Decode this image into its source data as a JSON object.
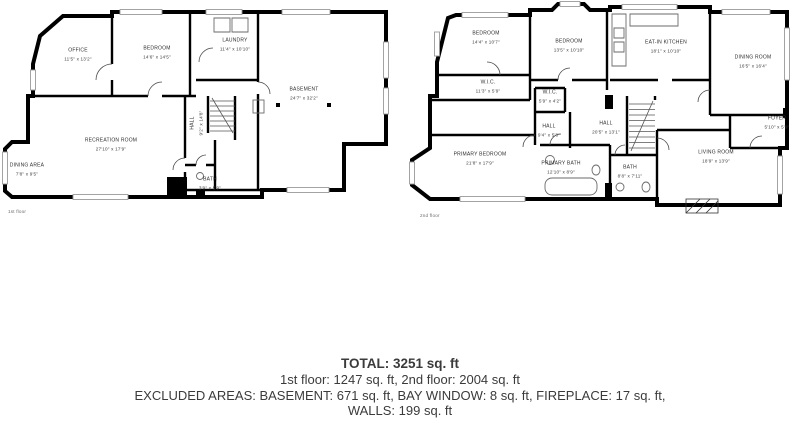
{
  "floor1": {
    "label": "1st floor",
    "rooms": [
      {
        "name": "OFFICE",
        "dims": "11'5\" x 13'2\""
      },
      {
        "name": "BEDROOM",
        "dims": "14'6\" x 14'5\""
      },
      {
        "name": "LAUNDRY",
        "dims": "11'4\" x 10'10\""
      },
      {
        "name": "BASEMENT",
        "dims": "24'7\" x 32'2\""
      },
      {
        "name": "RECREATION ROOM",
        "dims": "27'10\" x 17'9\""
      },
      {
        "name": "DINING AREA",
        "dims": "7'8\" x 9'5\""
      },
      {
        "name": "HALL",
        "dims": "9'2\" x 14'8\""
      },
      {
        "name": "BATH",
        "dims": "3'9\" x 5'9\""
      }
    ]
  },
  "floor2": {
    "label": "2nd floor",
    "rooms": [
      {
        "name": "BEDROOM",
        "dims": "14'4\" x 10'7\""
      },
      {
        "name": "BEDROOM",
        "dims": "13'5\" x 10'10\""
      },
      {
        "name": "EAT-IN KITCHEN",
        "dims": "18'1\" x 10'10\""
      },
      {
        "name": "DINING ROOM",
        "dims": "16'5\" x 16'4\""
      },
      {
        "name": "W.I.C.",
        "dims": "11'3\" x 5'9\""
      },
      {
        "name": "W.I.C.",
        "dims": "5'9\" x 4'2\""
      },
      {
        "name": "HALL",
        "dims": "9'4\" x 5'8\""
      },
      {
        "name": "HALL",
        "dims": "20'5\" x 13'1\""
      },
      {
        "name": "PRIMARY BEDROOM",
        "dims": "21'8\" x 17'9\""
      },
      {
        "name": "PRIMARY BATH",
        "dims": "12'10\" x 8'9\""
      },
      {
        "name": "BATH",
        "dims": "8'8\" x 7'11\""
      },
      {
        "name": "LIVING ROOM",
        "dims": "18'9\" x 13'9\""
      },
      {
        "name": "FOYER",
        "dims": "5'10\" x 5'9\""
      }
    ]
  },
  "summary": {
    "total": "TOTAL: 3251 sq. ft",
    "floors_line": "1st floor: 1247 sq. ft, 2nd floor: 2004 sq. ft",
    "excluded_line1": "EXCLUDED AREAS: BASEMENT: 671 sq. ft, BAY WINDOW: 8 sq. ft, FIREPLACE: 17 sq. ft,",
    "excluded_line2": "WALLS: 199 sq. ft",
    "disclaimer": "FLOOR PLAN CREATED BY CUBICASA APP. MEASUREMENTS DEEMED HIGHLY RELIABLE BUT NOT GUARANTEED."
  },
  "colors": {
    "wall": "#000000",
    "text": "#3b3b3b",
    "window": "#9a9a9a"
  }
}
